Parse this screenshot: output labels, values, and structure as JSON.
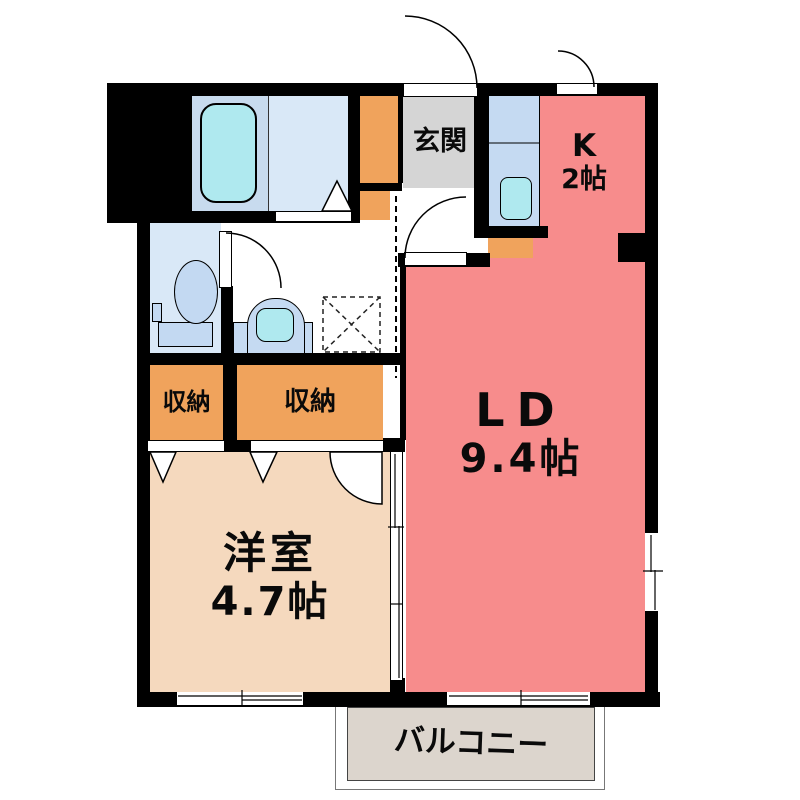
{
  "plan_title": "1LDK apartment floor plan",
  "palette": {
    "wall": "#000000",
    "living_dining_kitchen": "#F78C8C",
    "western_room": "#F5D9BE",
    "storage": "#F0A35C",
    "entrance": "#D5D5D5",
    "plumbing_counter": "#C5DAF2",
    "bath_floor": "#D9E8F7",
    "tub_sink": "#AFE9EF",
    "balcony": "#DCD5CD"
  },
  "rooms": {
    "living_dining": {
      "label": "LD",
      "size": "9.4帖"
    },
    "kitchen": {
      "label": "K",
      "size": "2帖"
    },
    "western_room": {
      "label": "洋室",
      "size": "4.7帖"
    },
    "entrance": {
      "label": "玄関"
    },
    "storage_left": {
      "label": "収納"
    },
    "storage_right": {
      "label": "収納"
    },
    "balcony": {
      "label": "バルコニー"
    }
  },
  "fixtures": [
    "bathtub",
    "toilet",
    "washbasin",
    "kitchen-sink",
    "washing-machine-pan"
  ]
}
